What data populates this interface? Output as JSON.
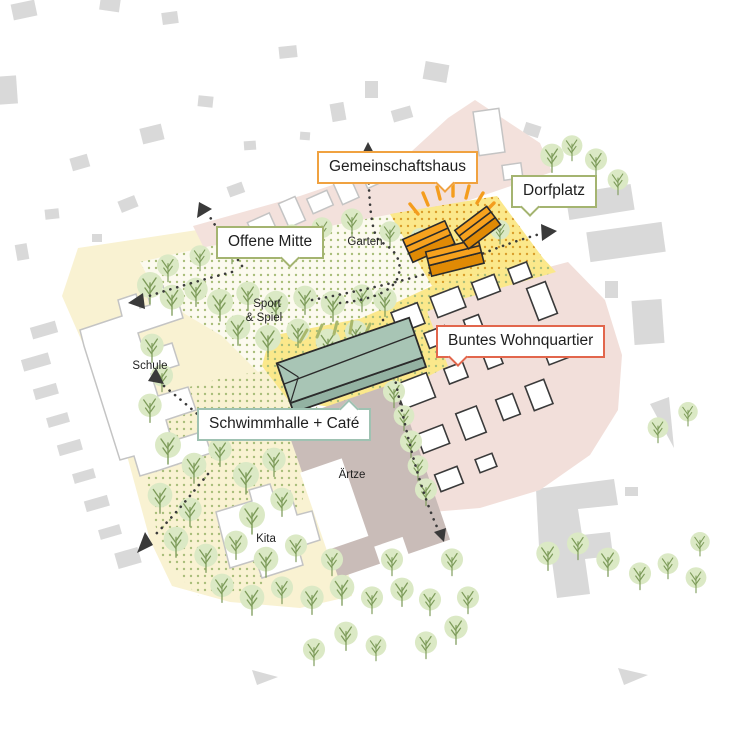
{
  "callouts": {
    "gemeinschaftshaus": {
      "label": "Gemeinschaftshaus",
      "accent": "#F0A240"
    },
    "dorfplatz": {
      "label": "Dorfplatz",
      "accent": "#A4B470"
    },
    "offene_mitte": {
      "label": "Offene Mitte",
      "accent": "#A4B470"
    },
    "schwimmhalle": {
      "label": "Schwimmhalle + Café",
      "accent": "#9FC2B2"
    },
    "wohnquartier": {
      "label": "Buntes Wohnquartier",
      "accent": "#E2664C"
    }
  },
  "map_texts": {
    "garten": "Garten",
    "sport_line1": "Sport",
    "sport_line2": "& Spiel",
    "schule": "Schule",
    "aerzte": "Ärtze",
    "kita": "Kita"
  },
  "colors": {
    "site_pale_yellow": "#F9F2D2",
    "plaza_yellow": "#FBE88B",
    "existing_pink": "#F3E1DC",
    "aerzte_mauve": "#C9BCB8",
    "context_grey": "#D9D9D9",
    "tree_fill": "#DBE9C5",
    "tree_stroke": "#7E9C5B",
    "gemeinschaftshaus_orange": "#F49D1D",
    "schwimmhalle_sage": "#A8C5B5",
    "outline_dark": "#2B2B2B"
  }
}
